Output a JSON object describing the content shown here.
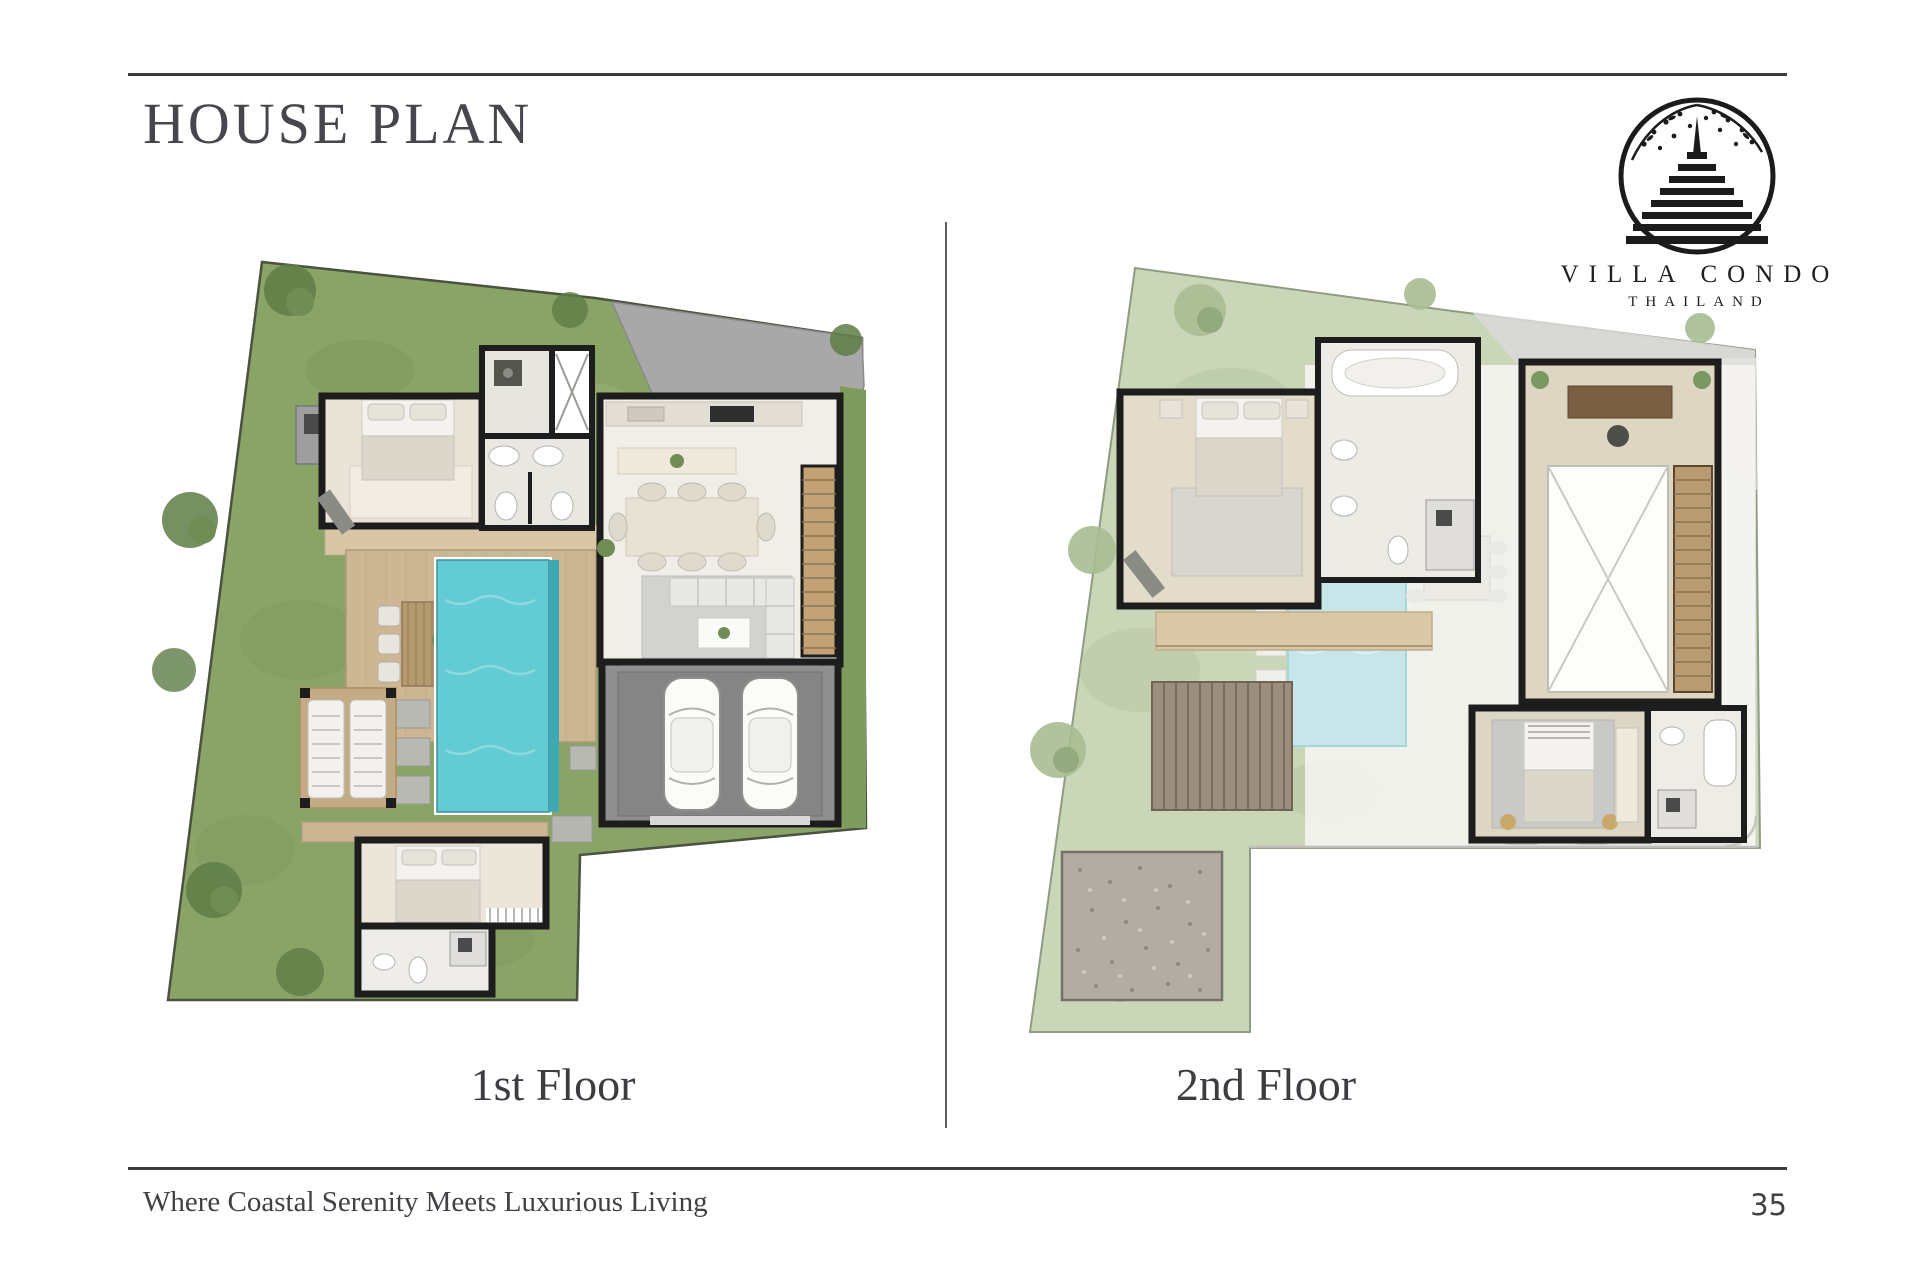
{
  "page": {
    "title": "HOUSE PLAN",
    "footer_tagline": "Where Coastal Serenity Meets Luxurious Living",
    "page_number": "35"
  },
  "logo": {
    "brand": "VILLA CONDO",
    "country": "THAILAND",
    "symbol": "chedi-spire-in-circle-with-branches"
  },
  "plans": {
    "first": {
      "label": "1st Floor"
    },
    "second": {
      "label": "2nd Floor"
    }
  },
  "colors": {
    "rule": "#3c3c3c",
    "text": "#3f4145",
    "grass": "#8aa468",
    "grass_faded": "#c9d6b8",
    "pool": "#63cbd4",
    "pool_faded": "#c6e6e9",
    "deck": "#cdb694",
    "wall": "#1d1d1d",
    "driveway": "#a8a8a8"
  }
}
